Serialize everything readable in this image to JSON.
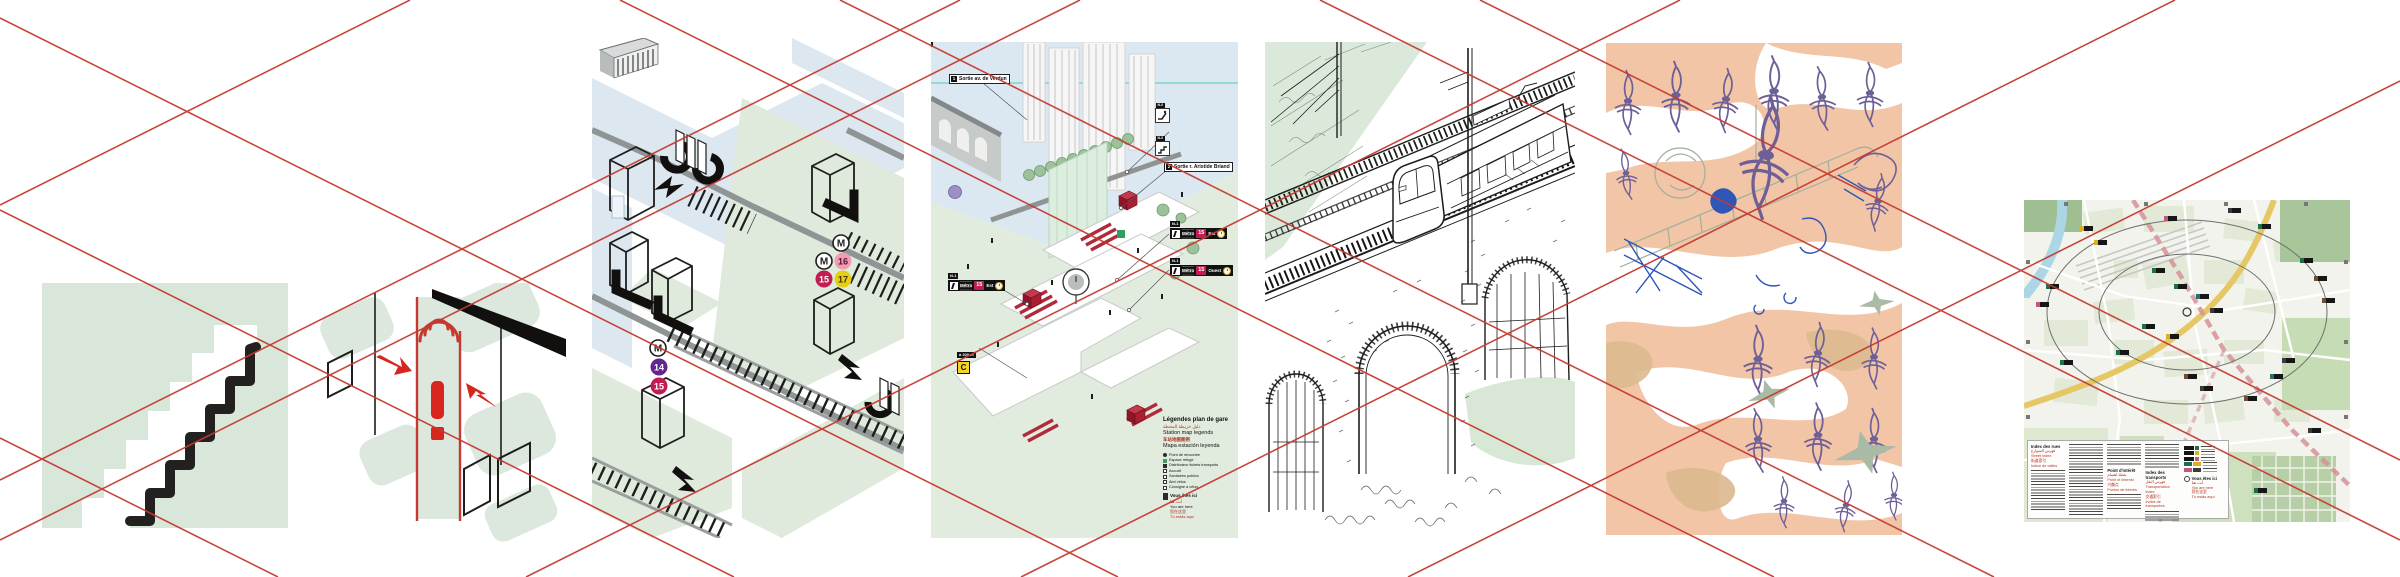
{
  "colors": {
    "guide_red": "#c43a31",
    "panel_green": "#d9e7da",
    "panel_blue": "#dde8f1",
    "salmon": "#f2c5a6",
    "metro_14": "#63268f",
    "metro_15": "#c01d52",
    "metro_16": "#ef9cb4",
    "metro_17": "#e5ce13"
  },
  "p3": {
    "m": "M",
    "l14": "14",
    "l15": "15",
    "l16": "16",
    "l17": "17"
  },
  "p4": {
    "callout1_num": "1",
    "callout1": "Sortie av. de Verdun",
    "callout2_num": "2",
    "callout2": "Sortie r. Aristide Briand",
    "level_tab": "N-1",
    "level_tab0": "N-0",
    "metro": "Métro",
    "line15": "15",
    "dir_est": "Est",
    "dir_ouest": "Ouest",
    "dist_tab": "à 200 m",
    "rer_c": "C",
    "legend": {
      "title_fr": "Légendes plan de gare",
      "title_ar": "دليل خريطة المحطة",
      "title_en": "Station map legends",
      "title_zh": "车站地图图例",
      "title_es": "Mapa estación leyenda",
      "items": [
        "Point de rencontre",
        "Espace refuge",
        "Distributeur tickets transports",
        "Accueil",
        "Sanitaires publics",
        "Abri vélos",
        "Consigne à vélos"
      ],
      "here_fr": "Vous êtes ici",
      "here_ar": "أنت هنا",
      "here_en": "You are here",
      "here_zh": "您在这里",
      "here_es": "Tú estás aquí"
    }
  },
  "p7": {
    "legend": {
      "streets_fr": "Index des rues",
      "streets_ar": "فهرس الشوارع",
      "streets_en": "Street index",
      "streets_zh": "街道索引",
      "streets_es": "Indice de calles",
      "poi_fr": "Point d'intérêt",
      "poi_ar": "نقطة اهتمام",
      "poi_en": "Point of interest",
      "poi_zh": "兴趣点",
      "poi_es": "Puntos de interés",
      "transport_fr": "Index des transports",
      "transport_ar": "فهرس النقل",
      "transport_en": "Transportation index",
      "transport_zh": "交通索引",
      "transport_es": "Índice de transportes",
      "here_fr": "Vous êtes ici",
      "here_ar": "أنت هنا",
      "here_en": "You are here",
      "here_zh": "您在这里",
      "here_es": "Tú estás aquí"
    }
  }
}
